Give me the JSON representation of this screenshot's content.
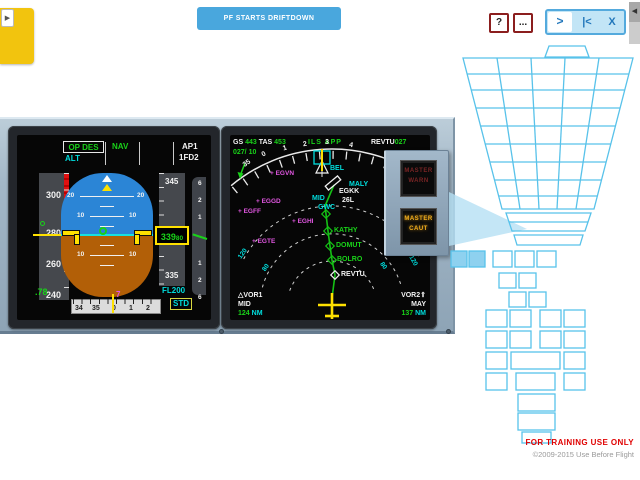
{
  "page": {
    "training_note": "FOR TRAINING USE ONLY",
    "copyright": "©2009-2015 Use Before Flight"
  },
  "top": {
    "event_button": "PF STARTS DRIFTDOWN",
    "help": "?",
    "more": "...",
    "forward": ">",
    "restart": "|<",
    "close": "X",
    "left_tab_arrow": "▶",
    "right_tab_arrow": "◀"
  },
  "colors": {
    "accent_blue": "#49a7dd",
    "button_border_red": "#8b1e1e",
    "pfd_sky": "#2b85d6",
    "pfd_ground": "#b25f07",
    "avionics_green": "#19d219",
    "avionics_cyan": "#00dede",
    "avionics_magenta": "#e257e2",
    "avionics_yellow": "#ffe100",
    "caution_amber": "#f0ad1d",
    "wireframe_cyan": "#58c2ea",
    "training_red": "#e00000"
  },
  "pfd": {
    "fma": {
      "vertical_mode": "OP DES",
      "armed_mode": "ALT",
      "lateral_mode": "NAV",
      "ap_status": "AP1",
      "fd_status": "1FD2"
    },
    "speed": {
      "ticks": [
        "300",
        "280",
        "260",
        "240"
      ],
      "mach": ".78"
    },
    "attitude": {
      "pitch_20": "20",
      "pitch_10": "10",
      "pitch_m10": "10"
    },
    "heading": {
      "ticks": [
        "34",
        "35",
        "0",
        "1",
        "2"
      ],
      "bug": "7"
    },
    "altitude": {
      "tick_top": "345",
      "tick_bottom": "335",
      "current": "339",
      "drum": "80",
      "selected": "FL200",
      "baro": "STD"
    },
    "vsi": {
      "up": [
        "6",
        "2",
        "1"
      ],
      "down": [
        "1",
        "2",
        "6"
      ]
    }
  },
  "nd": {
    "gs_label": "GS",
    "gs": "443",
    "tas_label": "TAS",
    "tas": "453",
    "wind": "027/ 10",
    "approach_mode": "ILS APP",
    "to_waypoint": "REVTU",
    "to_bearing": "027",
    "compass": [
      "35",
      "0",
      "1",
      "2",
      "3",
      "4"
    ],
    "ranges": {
      "r120_left": "120",
      "r80_left": "80",
      "r80_right": "80",
      "r120_right": "120"
    },
    "route": {
      "bel": "BEL",
      "maly": "MALY",
      "egkk": "EGKK",
      "rwy": "26L",
      "mid": "MID",
      "gwc": "GWC",
      "kathy": "KATHY",
      "domut": "DOMUT",
      "bolro": "BOLRO",
      "revtu": "REVTU"
    },
    "airports": {
      "egvn": "+ EGVN",
      "eggd": "+ EGGD",
      "egff": "+ EGFF",
      "eghi": "+ EGHI",
      "egte": "+ EGTE"
    },
    "vor1": {
      "icon": "△",
      "name": "VOR1",
      "ident": "MID",
      "dist": "124",
      "unit": "NM"
    },
    "vor2": {
      "icon": "⇑",
      "name": "VOR2",
      "ident": "MAY",
      "dist": "137",
      "unit": "NM"
    }
  },
  "warn_panel": {
    "warn_line1": "MASTER",
    "warn_line2": "WARN",
    "caut_line1": "MASTER",
    "caut_line2": "CAUT"
  }
}
